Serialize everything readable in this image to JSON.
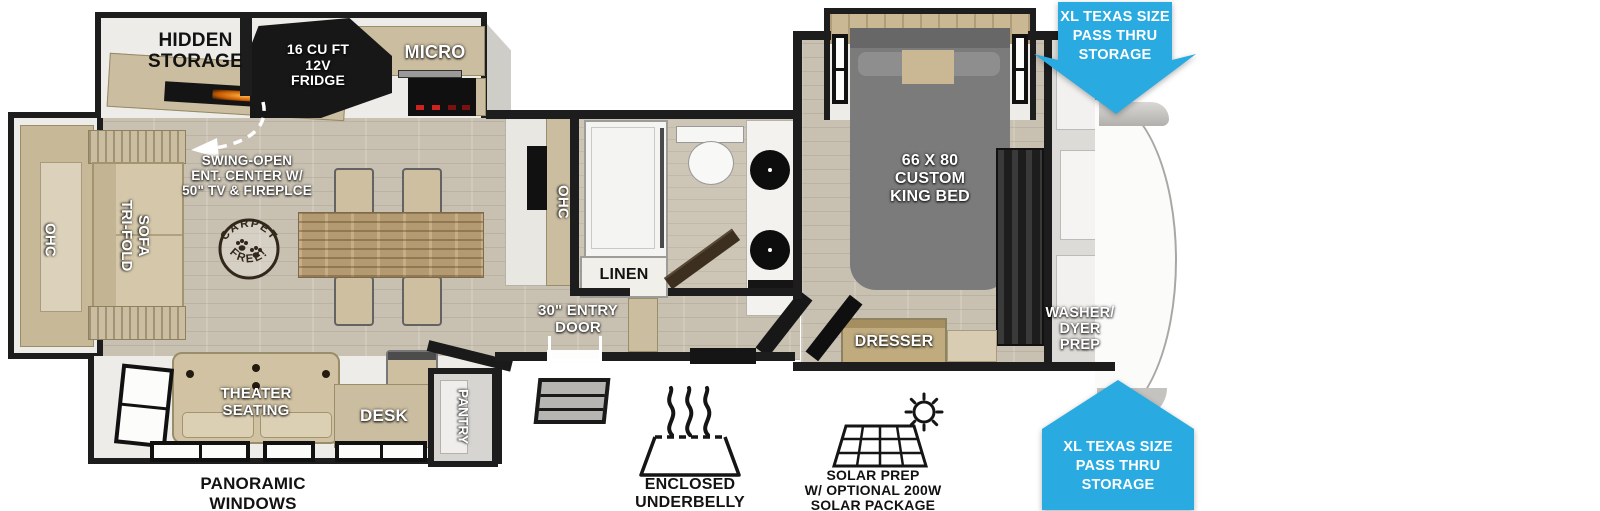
{
  "colors": {
    "arrow_blue": "#29ABE2",
    "wall_black": "#1D1D1D",
    "cabinet_tan": "#CBBDA0",
    "floor_wood": "#C8C0B1",
    "stamp_brown": "#31271A",
    "fireplace_orange": "#E08818"
  },
  "rooms": {
    "kitchen": {
      "hidden_storage": "HIDDEN\nSTORAGE",
      "fridge": "16 CU FT\n12V\nFRIDGE",
      "micro": "MICRO",
      "ent_center": "SWING-OPEN\nENT. CENTER W/\n50\" TV & FIREPLCE",
      "ohc": "OHC"
    },
    "living": {
      "ohc": "OHC",
      "sofa": "TRI-FOLD\nSOFA",
      "theater": "THEATER\nSEATING",
      "desk": "DESK",
      "pantry": "PANTRY"
    },
    "bath": {
      "linen": "LINEN"
    },
    "entry": {
      "door": "30\" ENTRY\nDOOR"
    },
    "bedroom": {
      "bed": "66 X 80\nCUSTOM\nKING BED",
      "dresser": "DRESSER",
      "washer_dryer": "WASHER/\nDYER\nPREP"
    }
  },
  "callouts": {
    "pass_thru_top": "XL TEXAS SIZE\nPASS THRU\nSTORAGE",
    "pass_thru_bottom": "XL TEXAS SIZE\nPASS THRU\nSTORAGE",
    "panoramic_windows": "PANORAMIC\nWINDOWS",
    "enclosed_underbelly": "ENCLOSED UNDERBELLY\nW/ 12V HEATING PADS",
    "solar_prep": "SOLAR PREP\nW/ OPTIONAL 200W\nSOLAR PACKAGE",
    "carpet_stamp_top": "CARPET",
    "carpet_stamp_bottom": "FREE!"
  }
}
